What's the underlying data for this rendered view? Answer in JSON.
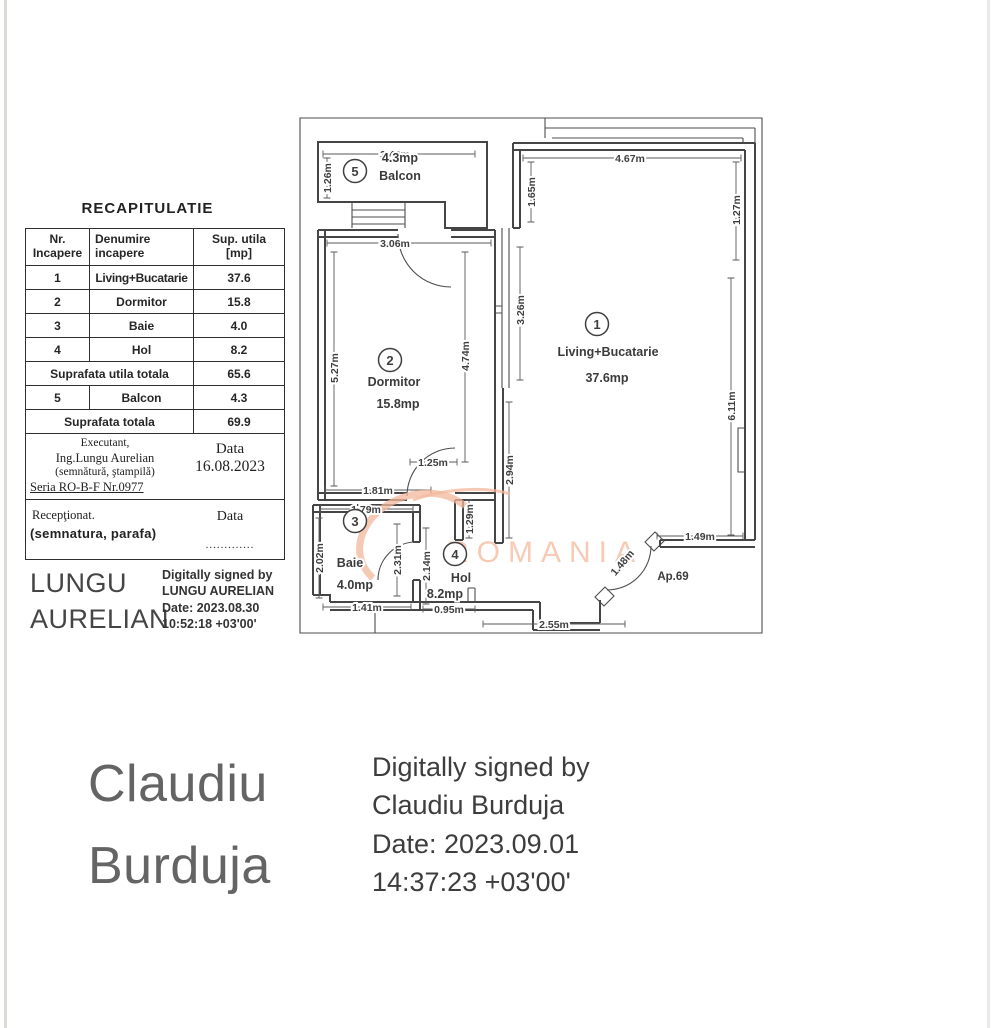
{
  "recap_table": {
    "title": "RECAPITULATIE",
    "headers": {
      "col1_line1": "Nr.",
      "col1_line2": "Incapere",
      "col2_line1": "Denumire",
      "col2_line2": "incapere",
      "col3_line1": "Sup. utila",
      "col3_line2": "[mp]"
    },
    "rows": [
      {
        "nr": "1",
        "name": "Living+Bucatarie",
        "area": "37.6"
      },
      {
        "nr": "2",
        "name": "Dormitor",
        "area": "15.8"
      },
      {
        "nr": "3",
        "name": "Baie",
        "area": "4.0"
      },
      {
        "nr": "4",
        "name": "Hol",
        "area": "8.2"
      }
    ],
    "total_utila": {
      "label": "Suprafata  utila  totala",
      "value": "65.6"
    },
    "balcon_row": {
      "nr": "5",
      "name": "Balcon",
      "area": "4.3"
    },
    "total": {
      "label": "Suprafata  totala",
      "value": "69.9"
    },
    "executant": {
      "line1": "Executant,",
      "line2": "Ing.Lungu Aurelian",
      "line3": "(semnătură, ştampilă)",
      "line4": "Seria RO-B-F Nr.0977",
      "data_label": "Data",
      "date": "16.08.2023"
    },
    "receptionat": {
      "line1": "Recepţionat.",
      "line2": "(semnatura,  parafa)",
      "data_label": "Data",
      "dots": "............."
    }
  },
  "signature_lungu": {
    "name_line1": "LUNGU",
    "name_line2": "AURELIAN",
    "detail1": "Digitally signed by",
    "detail2": "LUNGU AURELIAN",
    "detail3": "Date: 2023.08.30",
    "detail4": "10:52:18 +03'00'"
  },
  "signature_burduja": {
    "name_line1": "Claudiu",
    "name_line2": "Burduja",
    "detail1": "Digitally signed by",
    "detail2": "Claudiu Burduja",
    "detail3": "Date: 2023.09.01",
    "detail4": "14:37:23 +03'00'"
  },
  "floor_plan": {
    "apartment_label": "Ap.69",
    "watermark": "ROMANIA",
    "watermark_color": "#f5bda2",
    "rooms": [
      {
        "num": "1",
        "cx": 302,
        "cy": 214,
        "labels": [
          {
            "t": "Living+Bucatarie",
            "x": 313,
            "y": 246
          },
          {
            "t": "37.6mp",
            "x": 312,
            "y": 272
          }
        ]
      },
      {
        "num": "2",
        "cx": 95,
        "cy": 250,
        "labels": [
          {
            "t": "Dormitor",
            "x": 99,
            "y": 276
          },
          {
            "t": "15.8mp",
            "x": 103,
            "y": 298
          }
        ]
      },
      {
        "num": "3",
        "cx": 60,
        "cy": 411,
        "labels": [
          {
            "t": "Baie",
            "x": 55,
            "y": 457
          },
          {
            "t": "4.0mp",
            "x": 60,
            "y": 479
          }
        ]
      },
      {
        "num": "4",
        "cx": 160,
        "cy": 444,
        "labels": [
          {
            "t": "Hol",
            "x": 166,
            "y": 472
          },
          {
            "t": "8.2mp",
            "x": 150,
            "y": 488
          }
        ]
      },
      {
        "num": "5",
        "cx": 60,
        "cy": 61,
        "labels": [
          {
            "t": "4.3mp",
            "x": 105,
            "y": 52
          },
          {
            "t": "Balcon",
            "x": 105,
            "y": 70
          }
        ]
      }
    ],
    "dimensions": [
      {
        "t": "3.40m",
        "x": 100,
        "y": 48,
        "r": 0
      },
      {
        "t": "1.26m",
        "x": 36,
        "y": 68,
        "r": -90
      },
      {
        "t": "4.67m",
        "x": 335,
        "y": 52,
        "r": 0
      },
      {
        "t": "1.27m",
        "x": 445,
        "y": 100,
        "r": -90
      },
      {
        "t": "1.65m",
        "x": 240,
        "y": 82,
        "r": -90
      },
      {
        "t": "3.06m",
        "x": 100,
        "y": 137,
        "r": 0
      },
      {
        "t": "3.26m",
        "x": 229,
        "y": 200,
        "r": -90
      },
      {
        "t": "5.27m",
        "x": 43,
        "y": 258,
        "r": -90
      },
      {
        "t": "4.74m",
        "x": 174,
        "y": 246,
        "r": -90
      },
      {
        "t": "2.94m",
        "x": 218,
        "y": 360,
        "r": -90
      },
      {
        "t": "6.11m",
        "x": 440,
        "y": 296,
        "r": -90
      },
      {
        "t": "1.25m",
        "x": 138,
        "y": 356,
        "r": 0
      },
      {
        "t": "1.81m",
        "x": 83,
        "y": 384,
        "r": 0
      },
      {
        "t": "1.29m",
        "x": 178,
        "y": 409,
        "r": -90
      },
      {
        "t": "1.79m",
        "x": 71,
        "y": 403,
        "r": 0
      },
      {
        "t": "2.02m",
        "x": 28,
        "y": 448,
        "r": -90
      },
      {
        "t": "2.31m",
        "x": 106,
        "y": 450,
        "r": -90
      },
      {
        "t": "2.14m",
        "x": 135,
        "y": 456,
        "r": -90
      },
      {
        "t": "1.41m",
        "x": 72,
        "y": 501,
        "r": 0
      },
      {
        "t": "0.95m",
        "x": 154,
        "y": 503,
        "r": 0
      },
      {
        "t": "2.55m",
        "x": 259,
        "y": 518,
        "r": 0
      },
      {
        "t": "1.49m",
        "x": 405,
        "y": 430,
        "r": 0
      },
      {
        "t": "1.48m",
        "x": 330,
        "y": 455,
        "r": -50
      }
    ]
  }
}
